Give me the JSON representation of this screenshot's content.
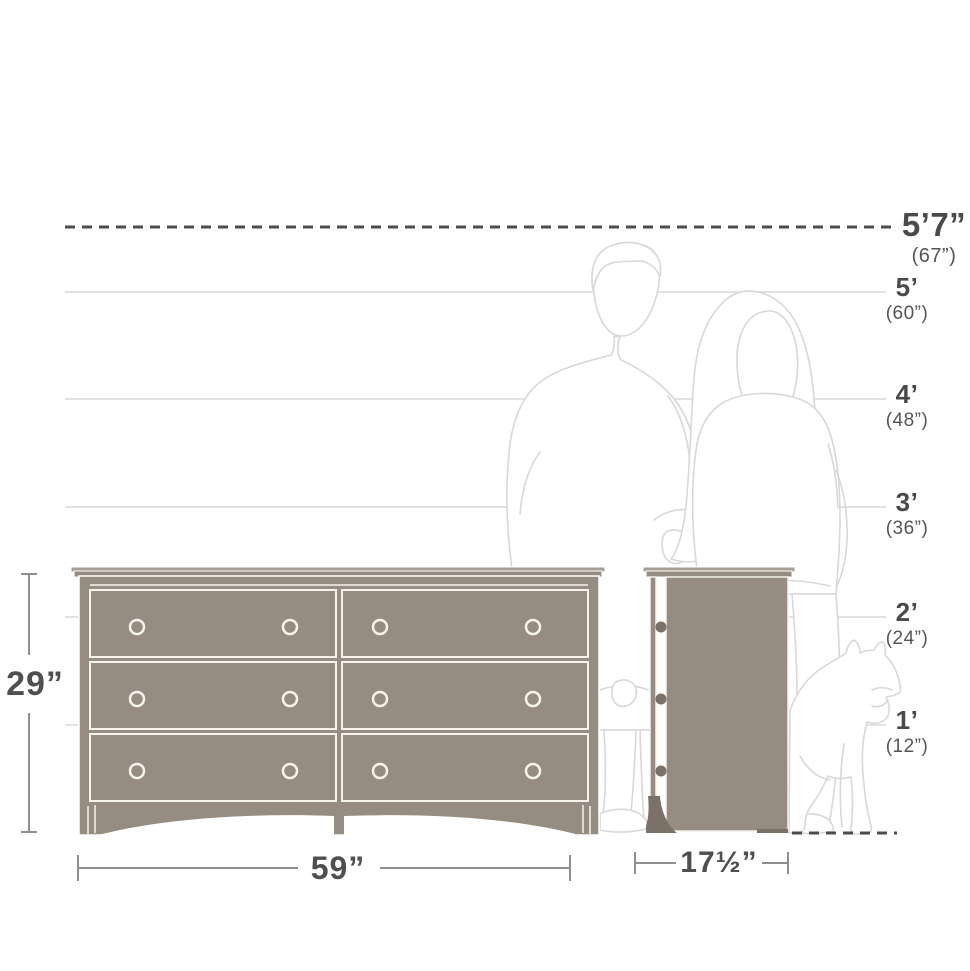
{
  "diagram_title": "dresser-dimensions-diagram",
  "height_chart": {
    "ceiling": {
      "feet": "5’7”",
      "inches": "(67”)"
    },
    "gridlines": [
      {
        "feet": "5’",
        "inches": "(60”)"
      },
      {
        "feet": "4’",
        "inches": "(48”)"
      },
      {
        "feet": "3’",
        "inches": "(36”)"
      },
      {
        "feet": "2’",
        "inches": "(24”)"
      },
      {
        "feet": "1’",
        "inches": "(12”)"
      }
    ]
  },
  "product": {
    "type": "6-drawer double dresser, front view and side view",
    "height": "29”",
    "width": "59”",
    "depth": "17½”"
  },
  "figures": {
    "man": "man-outline",
    "woman": "woman-outline",
    "dog": "dog-outline"
  },
  "colors": {
    "dresser_fill": "#968c81",
    "dresser_lip": "#a89d92",
    "dresser_dark_accent": "#7b7167",
    "outline_white": "#f6f3ed",
    "figure_line": "#d8d8d8",
    "gridline": "#e3e2e0",
    "dash_line": "#4c4c4c",
    "dimension_line": "#8f8f8f",
    "label_text": "#4a4a4a"
  }
}
